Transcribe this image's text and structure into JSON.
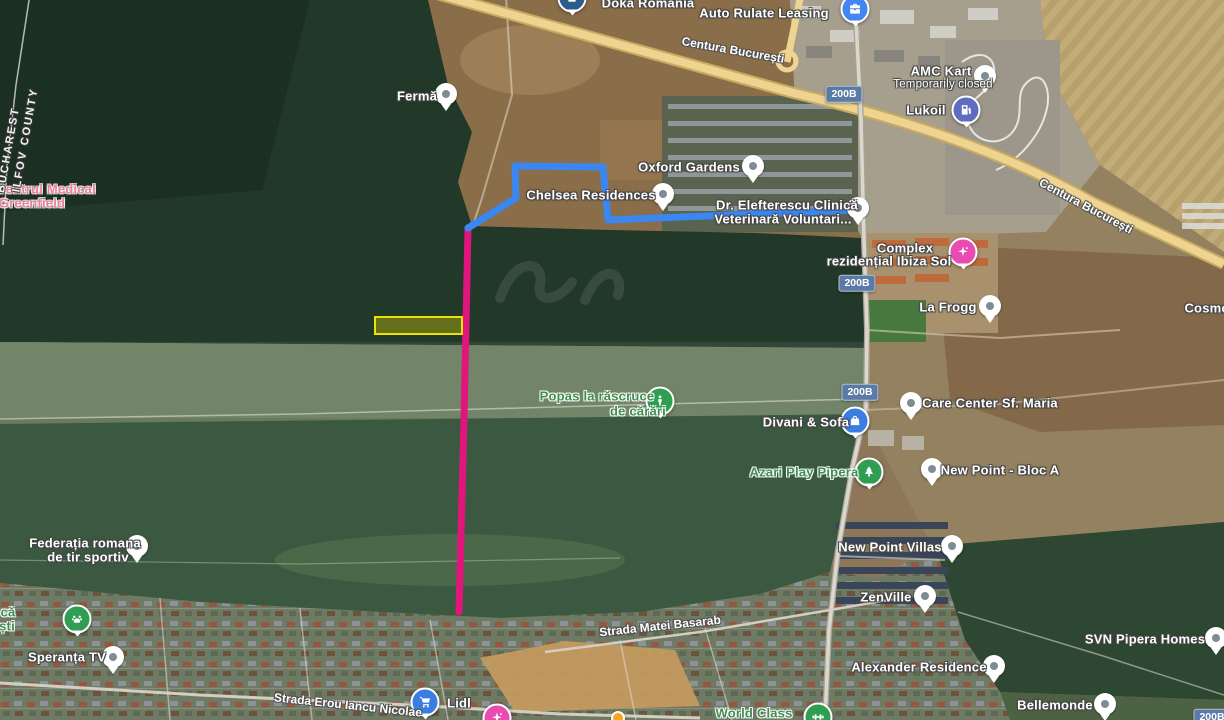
{
  "map": {
    "description": "Satellite map of Pipera / Voluntari area, Ilfov, Romania"
  },
  "boundary": {
    "labels": [
      {
        "text": "BUCHAREST",
        "x": 9,
        "y": 150,
        "rot": -80
      },
      {
        "text": "ILFOV COUNTY",
        "x": 26,
        "y": 140,
        "rot": -80
      }
    ]
  },
  "road_labels": [
    {
      "text": "Centura București",
      "x": 733,
      "y": 50,
      "rot": 10
    },
    {
      "text": "Centura București",
      "x": 1086,
      "y": 206,
      "rot": 28
    },
    {
      "text": "Strada Matei Basarab",
      "x": 660,
      "y": 626,
      "rot": -6
    },
    {
      "text": "Strada Erou Iancu Nicolae",
      "x": 348,
      "y": 705,
      "rot": 6
    }
  ],
  "road_badges": [
    {
      "text": "200B",
      "x": 844,
      "y": 94
    },
    {
      "text": "200B",
      "x": 857,
      "y": 283
    },
    {
      "text": "200B",
      "x": 860,
      "y": 392
    },
    {
      "text": "200B",
      "x": 1212,
      "y": 717
    }
  ],
  "routes": [
    {
      "name": "route-blue",
      "color": "#3a87f2",
      "width": 7,
      "points": "468,228 516,198 515,166 603,167 608,220 857,210"
    },
    {
      "name": "route-magenta",
      "color": "#e0167c",
      "width": 7,
      "points": "468,228 464,420 459,612"
    }
  ],
  "highlight_box": {
    "x": 375,
    "y": 317,
    "width": 87,
    "height": 17,
    "fill": "rgba(205,205,0,0.38)",
    "stroke": "#ece400"
  },
  "pois": [
    {
      "id": "doka-romania",
      "style": "white",
      "lines": [
        {
          "text": "Doka România",
          "x": 648,
          "y": 3
        }
      ],
      "marker": {
        "kind": "circle",
        "x": 572,
        "y": -2,
        "color": "#2b5d8c",
        "icon": "box-icon"
      }
    },
    {
      "id": "auto-rulate-leasing",
      "style": "white",
      "lines": [
        {
          "text": "Auto Rulate Leasing",
          "x": 764,
          "y": 13
        }
      ],
      "marker": {
        "kind": "circle",
        "x": 855,
        "y": 9,
        "color": "#4285f4",
        "icon": "briefcase-icon"
      }
    },
    {
      "id": "ferma",
      "style": "white",
      "lines": [
        {
          "text": "Fermă",
          "x": 417,
          "y": 96
        }
      ],
      "marker": {
        "kind": "pin",
        "x": 446,
        "y": 94
      }
    },
    {
      "id": "amc-kart",
      "style": "white",
      "lines": [
        {
          "text": "AMC Kart",
          "x": 941,
          "y": 71
        },
        {
          "text": "Temporarily closed",
          "x": 943,
          "y": 85,
          "cls": "sub"
        }
      ],
      "marker": {
        "kind": "pin",
        "x": 985,
        "y": 76
      }
    },
    {
      "id": "lukoil",
      "style": "white",
      "lines": [
        {
          "text": "Lukoil",
          "x": 926,
          "y": 110
        }
      ],
      "marker": {
        "kind": "circle",
        "x": 966,
        "y": 110,
        "color": "#5f6cc0",
        "icon": "fuel-icon"
      }
    },
    {
      "id": "oxford-gardens",
      "style": "white",
      "lines": [
        {
          "text": "Oxford Gardens",
          "x": 689,
          "y": 167
        }
      ],
      "marker": {
        "kind": "pin",
        "x": 753,
        "y": 166
      }
    },
    {
      "id": "chelsea-residences",
      "style": "white",
      "lines": [
        {
          "text": "Chelsea Residences",
          "x": 591,
          "y": 195
        }
      ],
      "marker": {
        "kind": "pin",
        "x": 663,
        "y": 194
      }
    },
    {
      "id": "elefterescu-clinica",
      "style": "white",
      "lines": [
        {
          "text": "Dr. Elefterescu Clinică",
          "x": 787,
          "y": 205
        },
        {
          "text": "Veterinară Voluntari...",
          "x": 783,
          "y": 219
        }
      ],
      "marker": {
        "kind": "pin",
        "x": 858,
        "y": 208
      }
    },
    {
      "id": "ibiza-sol",
      "style": "white",
      "lines": [
        {
          "text": "Complex",
          "x": 905,
          "y": 248
        },
        {
          "text": "rezidențial Ibiza Sol",
          "x": 889,
          "y": 261
        }
      ],
      "marker": {
        "kind": "circle",
        "x": 963,
        "y": 252,
        "color": "#e94bb0",
        "icon": "spa-icon"
      }
    },
    {
      "id": "la-frogg",
      "style": "white",
      "lines": [
        {
          "text": "La Frogg",
          "x": 948,
          "y": 307
        }
      ],
      "marker": {
        "kind": "pin",
        "x": 990,
        "y": 306
      }
    },
    {
      "id": "cosmopolis",
      "style": "white",
      "lines": [
        {
          "text": "Cosmo",
          "x": 1207,
          "y": 308
        }
      ]
    },
    {
      "id": "centrul-medical-greenfield",
      "style": "pink",
      "lines": [
        {
          "text": "Centrul Medical",
          "x": 46,
          "y": 189
        },
        {
          "text": "Greenfield",
          "x": 32,
          "y": 203
        }
      ]
    },
    {
      "id": "popas-rascruce",
      "style": "green",
      "lines": [
        {
          "text": "Popas la răscruce",
          "x": 597,
          "y": 396
        },
        {
          "text": "de cărări",
          "x": 638,
          "y": 411
        }
      ],
      "marker": {
        "kind": "circle",
        "x": 660,
        "y": 401,
        "color": "#2f9e53",
        "icon": "pedestrian-icon"
      }
    },
    {
      "id": "divani-sofa",
      "style": "white",
      "lines": [
        {
          "text": "Divani & Sofa",
          "x": 806,
          "y": 422
        }
      ],
      "marker": {
        "kind": "circle",
        "x": 855,
        "y": 421,
        "color": "#3b7de0",
        "icon": "bag-icon"
      }
    },
    {
      "id": "care-center-sf-maria",
      "style": "white",
      "lines": [
        {
          "text": "Care Center Sf. Maria",
          "x": 990,
          "y": 403
        }
      ],
      "marker": {
        "kind": "pin",
        "x": 911,
        "y": 403
      }
    },
    {
      "id": "new-point-bloc-a",
      "style": "white",
      "lines": [
        {
          "text": "New Point - Bloc A",
          "x": 1000,
          "y": 470
        }
      ],
      "marker": {
        "kind": "pin",
        "x": 932,
        "y": 469
      }
    },
    {
      "id": "azari-play-pipera",
      "style": "green",
      "lines": [
        {
          "text": "Azari Play Pipera",
          "x": 804,
          "y": 472
        }
      ],
      "marker": {
        "kind": "circle",
        "x": 869,
        "y": 472,
        "color": "#2f9e53",
        "icon": "tree-icon"
      }
    },
    {
      "id": "new-point-villas",
      "style": "white",
      "lines": [
        {
          "text": "New Point Villas",
          "x": 890,
          "y": 547
        }
      ],
      "marker": {
        "kind": "pin",
        "x": 952,
        "y": 546
      }
    },
    {
      "id": "zenville",
      "style": "white",
      "lines": [
        {
          "text": "ZenVille",
          "x": 886,
          "y": 597
        }
      ],
      "marker": {
        "kind": "pin",
        "x": 925,
        "y": 596
      }
    },
    {
      "id": "federatia-tir-sportiv",
      "style": "white",
      "lines": [
        {
          "text": "Federația romana",
          "x": 85,
          "y": 543
        },
        {
          "text": "de tir sportiv",
          "x": 88,
          "y": 557
        }
      ],
      "marker": {
        "kind": "pin",
        "x": 137,
        "y": 546
      }
    },
    {
      "id": "dog-park",
      "style": "green",
      "lines": [
        {
          "text": "că",
          "x": 8,
          "y": 612
        },
        {
          "text": "ști",
          "x": 7,
          "y": 626
        }
      ],
      "marker": {
        "kind": "circle",
        "x": 77,
        "y": 619,
        "color": "#2f9e53",
        "icon": "paw-icon"
      }
    },
    {
      "id": "speranta-tv",
      "style": "white",
      "lines": [
        {
          "text": "Speranța TV",
          "x": 67,
          "y": 657
        }
      ],
      "marker": {
        "kind": "pin",
        "x": 113,
        "y": 657
      }
    },
    {
      "id": "alexander-residence",
      "style": "white",
      "lines": [
        {
          "text": "Alexander Residence",
          "x": 919,
          "y": 667
        }
      ],
      "marker": {
        "kind": "pin",
        "x": 994,
        "y": 666
      }
    },
    {
      "id": "svn-pipera-homes",
      "style": "white",
      "lines": [
        {
          "text": "SVN Pipera Homes",
          "x": 1145,
          "y": 639
        }
      ],
      "marker": {
        "kind": "pin",
        "x": 1216,
        "y": 638
      }
    },
    {
      "id": "bellemonde",
      "style": "white",
      "lines": [
        {
          "text": "Bellemonde",
          "x": 1055,
          "y": 705
        }
      ],
      "marker": {
        "kind": "pin",
        "x": 1105,
        "y": 704
      }
    },
    {
      "id": "lidl",
      "style": "white",
      "lines": [
        {
          "text": "Lidl",
          "x": 459,
          "y": 703
        }
      ],
      "marker": {
        "kind": "circle",
        "x": 425,
        "y": 702,
        "color": "#3b7de0",
        "icon": "cart-icon"
      }
    },
    {
      "id": "hotel-poi",
      "style": "white",
      "lines": [],
      "marker": {
        "kind": "circle",
        "x": 497,
        "y": 718,
        "color": "#e94bb0",
        "icon": "spa-icon"
      }
    },
    {
      "id": "world-class",
      "style": "green",
      "lines": [
        {
          "text": "World Class",
          "x": 754,
          "y": 713
        }
      ],
      "marker": {
        "kind": "circle",
        "x": 818,
        "y": 717,
        "color": "#2f9e53",
        "icon": "dumbbell-icon"
      }
    },
    {
      "id": "minor-poi",
      "style": "white",
      "lines": [],
      "marker": {
        "kind": "dot",
        "x": 618,
        "y": 718,
        "color": "#f5a623"
      }
    }
  ]
}
